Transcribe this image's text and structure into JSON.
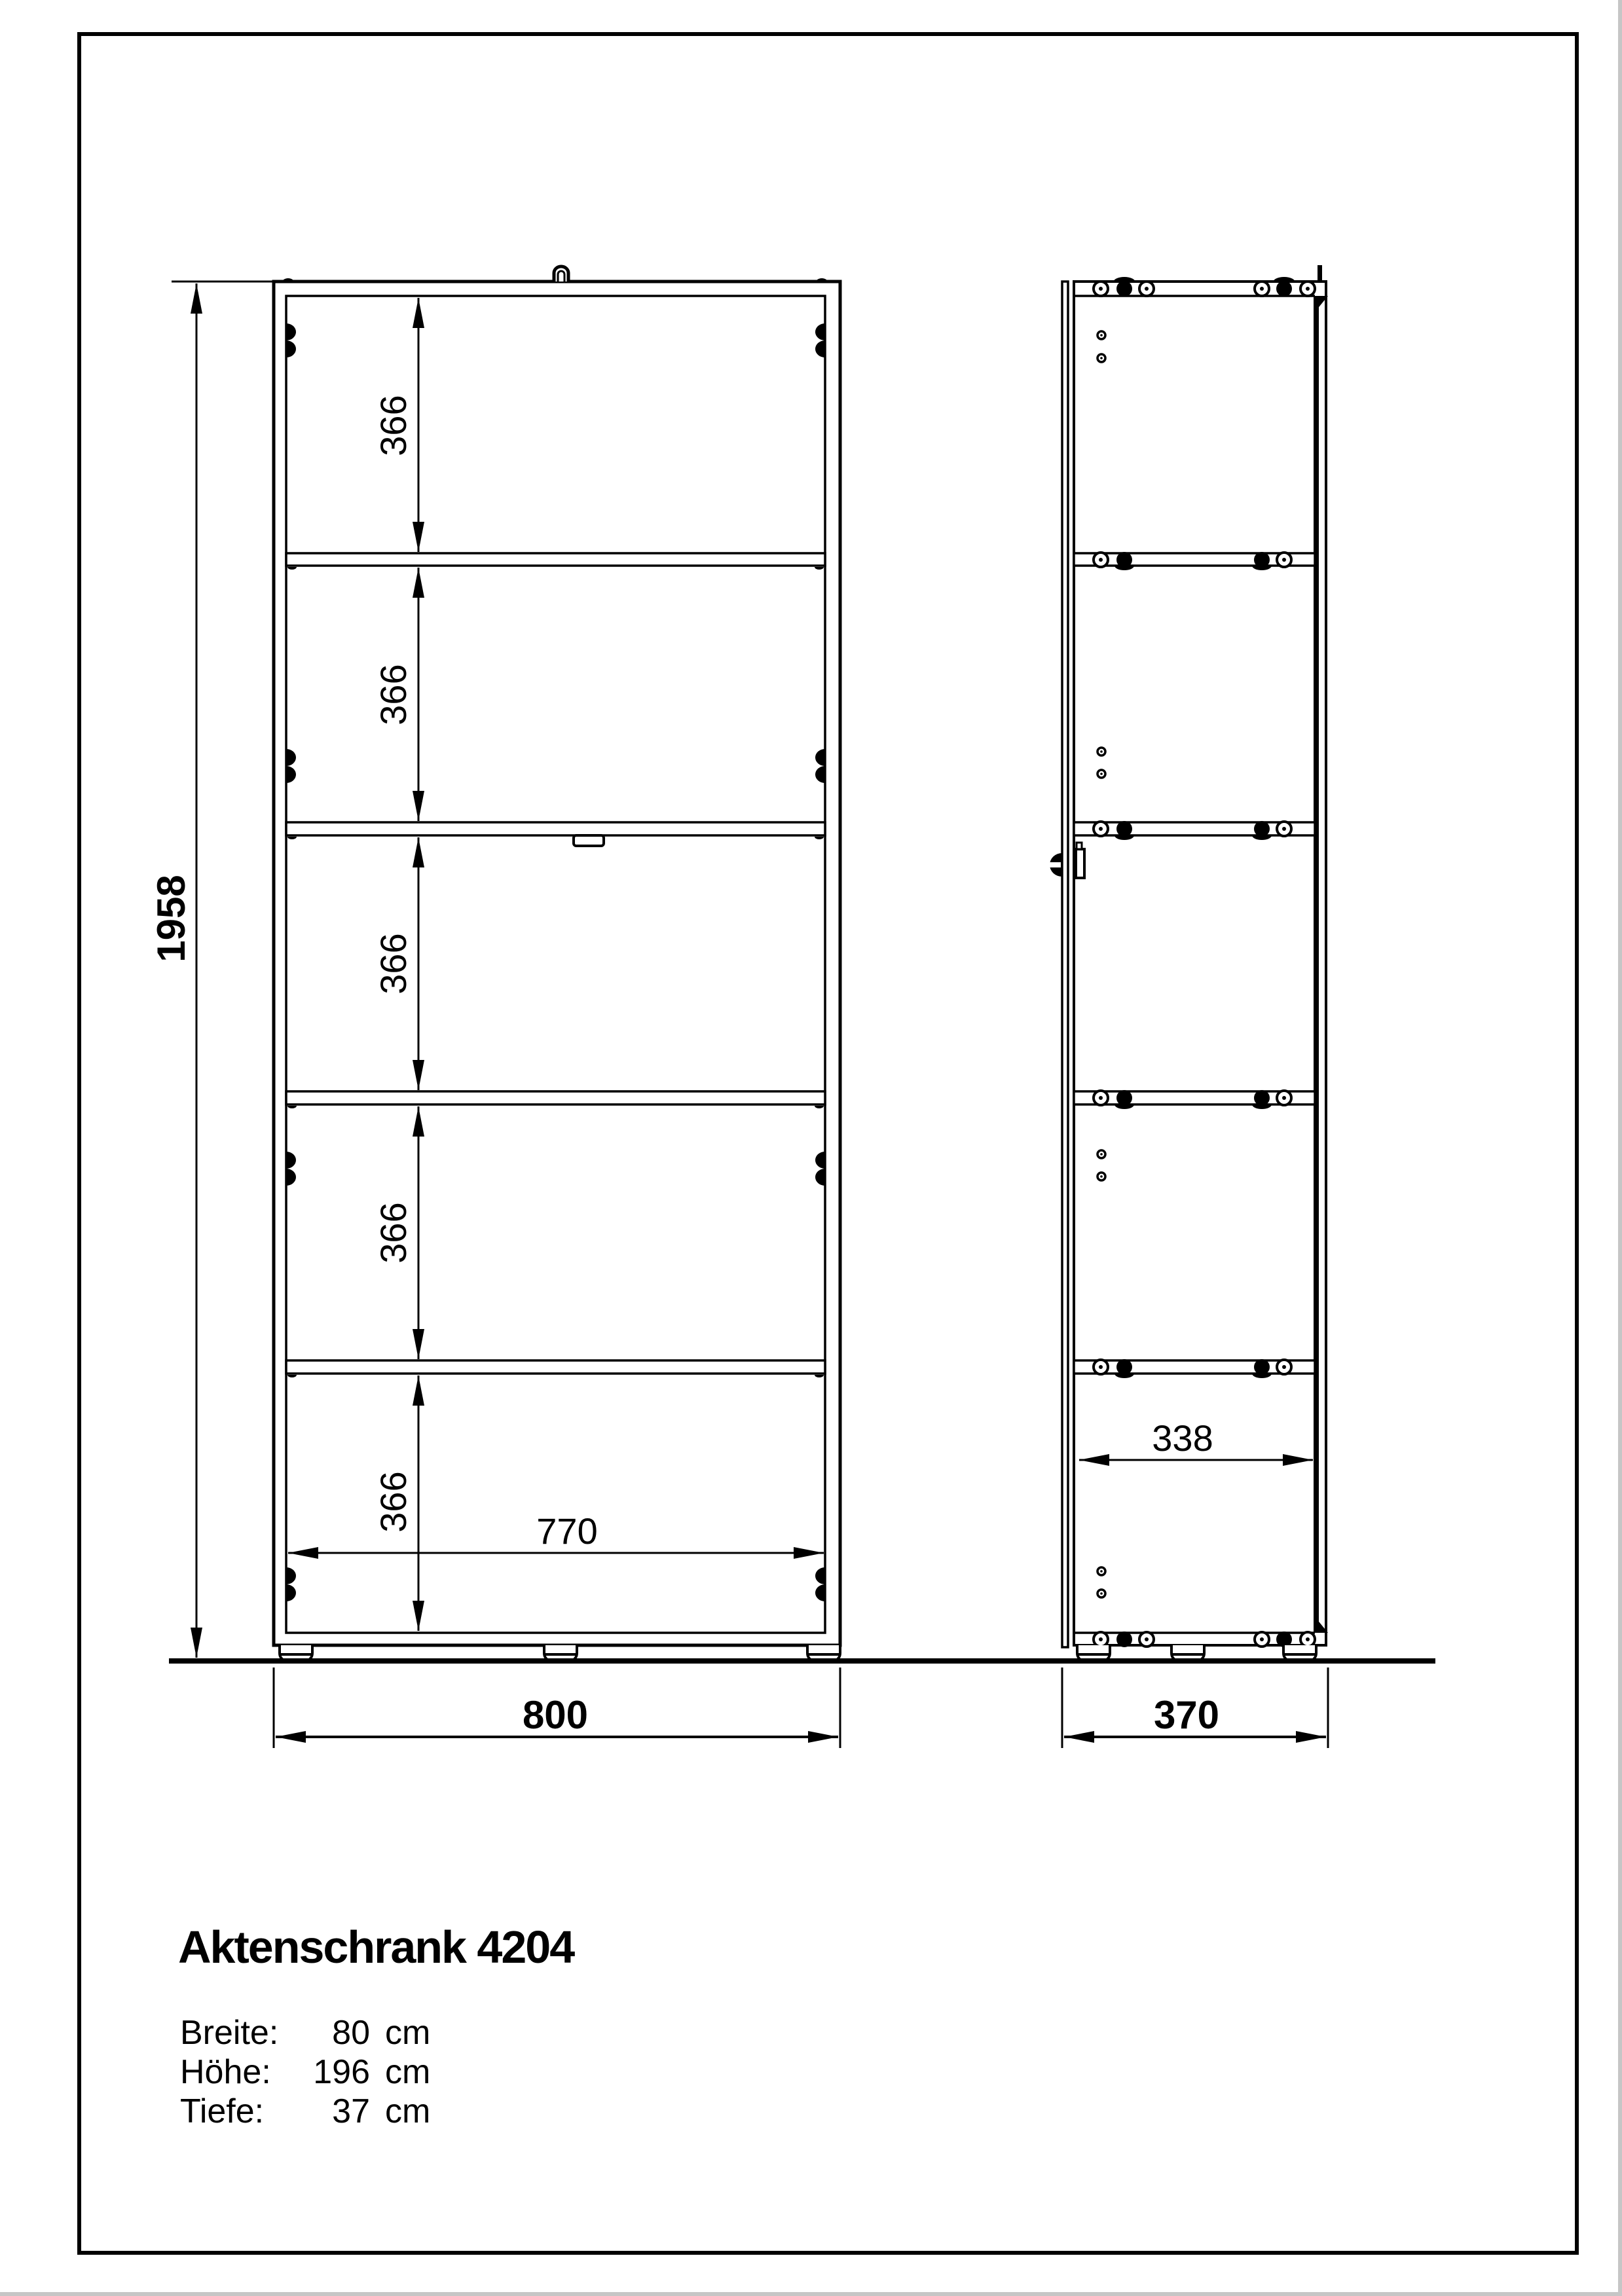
{
  "page": {
    "title": "Aktenschrank 4204",
    "specs": [
      {
        "label": "Breite:",
        "value": "80",
        "unit": "cm"
      },
      {
        "label": "Höhe:",
        "value": "196",
        "unit": "cm"
      },
      {
        "label": "Tiefe:",
        "value": "37",
        "unit": "cm"
      }
    ]
  },
  "dimensions": {
    "front": {
      "total_height": "1958",
      "compartment_height": "366",
      "inner_width": "770",
      "outer_width": "800"
    },
    "side": {
      "inner_depth": "338",
      "outer_depth": "370"
    }
  },
  "colors": {
    "line": "#000000",
    "background": "#ffffff",
    "page_edge": "#c6c6c6"
  }
}
